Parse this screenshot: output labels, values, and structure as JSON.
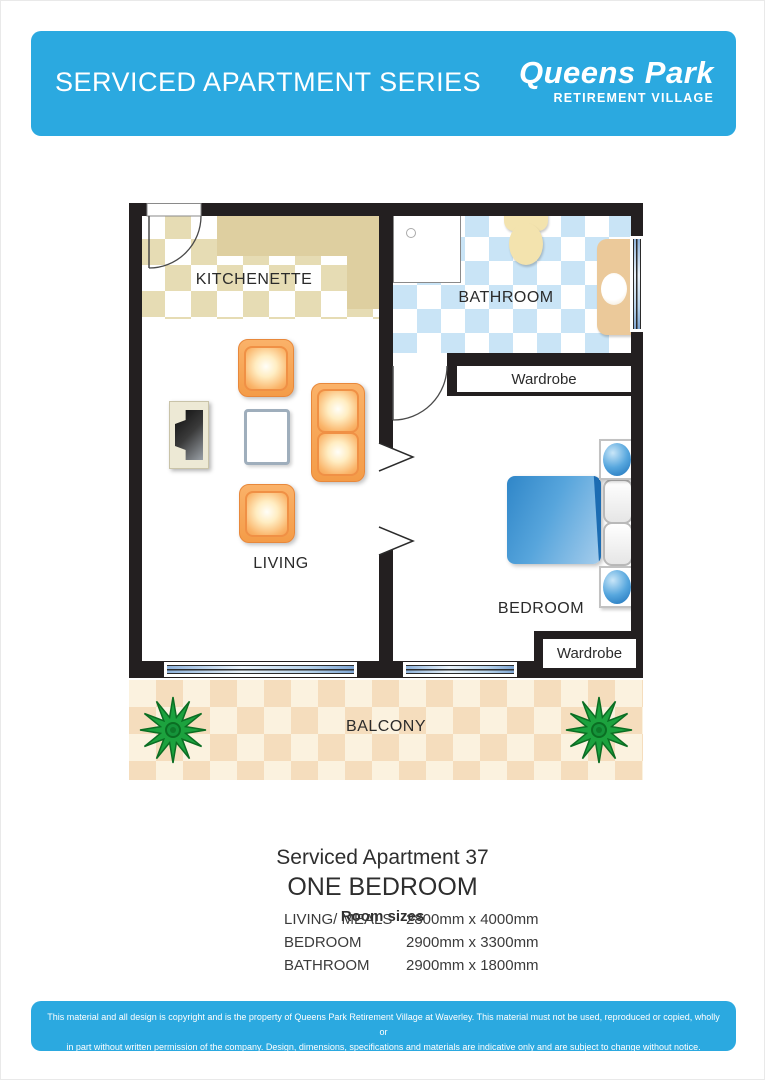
{
  "header": {
    "title": "SERVICED APARTMENT SERIES",
    "brand_name": "Queens Park",
    "brand_subtitle": "RETIREMENT VILLAGE"
  },
  "floorplan": {
    "labels": {
      "kitchenette": "KITCHENETTE",
      "bathroom": "BATHROOM",
      "living": "LIVING",
      "bedroom": "BEDROOM",
      "balcony": "BALCONY",
      "wardrobe_top": "Wardrobe",
      "wardrobe_bottom": "Wardrobe"
    }
  },
  "details": {
    "apartment_title": "Serviced Apartment 37",
    "apartment_type": "ONE BEDROOM",
    "room_sizes_heading": "Room sizes",
    "rows": [
      {
        "label": "LIVING/ MEALS",
        "size": "2800mm x 4000mm"
      },
      {
        "label": "BEDROOM",
        "size": "2900mm x 3300mm"
      },
      {
        "label": "BATHROOM",
        "size": "2900mm x 1800mm"
      }
    ]
  },
  "footer": {
    "line1": "This material and all design is copyright and is the property of Queens Park Retirement Village at Waverley. This material must not be used, reproduced or copied, wholly or",
    "line2": "in part without written permission of the company. Design, dimensions, specifications and materials are indicative only and are subject to change without notice."
  },
  "colors": {
    "accent": "#2BA9E0",
    "wall": "#231F20",
    "tan": "#E6DCB4",
    "counter": "#DECFA0",
    "bathblue": "#C9E4F6",
    "balconybase": "#FBF2DF",
    "balconysq": "#F5DDBD",
    "furnorange": "#FAB469",
    "bedblue": "#2F86C8",
    "fixture": "#F3E3AE",
    "vanity": "#EBC99A",
    "plantgreen": "#1CA23E"
  }
}
